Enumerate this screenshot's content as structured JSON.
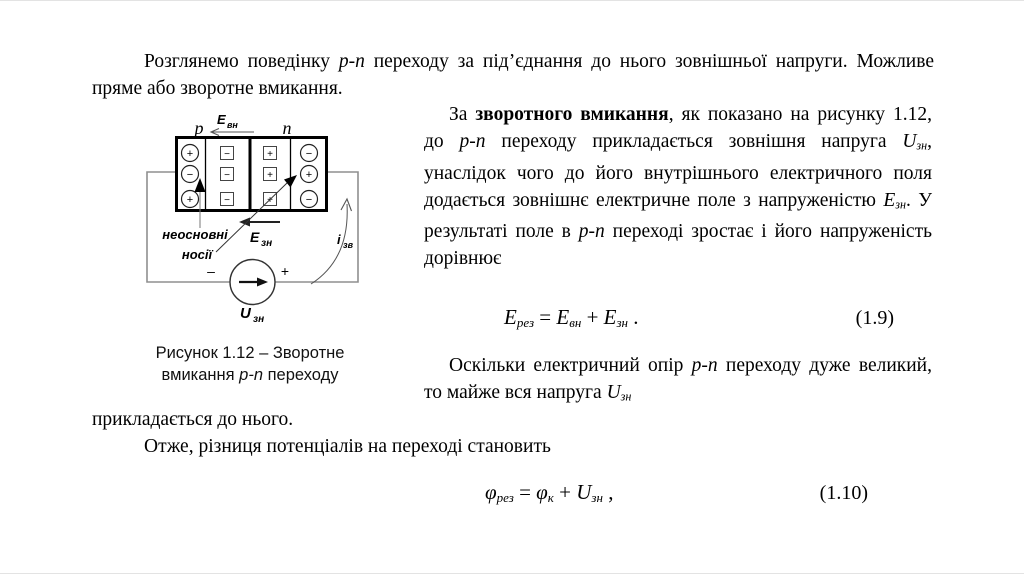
{
  "content": {
    "p1": [
      {
        "t": "Розглянемо поведінку "
      },
      {
        "t": "p-n",
        "s": "i"
      },
      {
        "t": " переходу за під’єднання до нього зовнішньої напруги. Можливе пряме або зворотне вмикання."
      }
    ],
    "p2": [
      {
        "t": "За "
      },
      {
        "t": "зворотного вмикання",
        "s": "b"
      },
      {
        "t": ", як показано на рисунку 1.12, до "
      },
      {
        "t": "p-n",
        "s": "i"
      },
      {
        "t": " переходу прикладається зовнішня напруга "
      },
      {
        "t": "U",
        "s": "i"
      },
      {
        "t": "зн",
        "s": "sub"
      },
      {
        "t": ", унаслідок чого до його внутрішнього електричного поля додається зовнішнє електричне поле з напруженістю "
      },
      {
        "t": "E",
        "s": "i"
      },
      {
        "t": "зн",
        "s": "sub"
      },
      {
        "t": ". У результаті поле в "
      },
      {
        "t": "p-n",
        "s": "i"
      },
      {
        "t": " переході зростає і його напруженість дорівнює"
      }
    ],
    "eq19": {
      "segments": [
        {
          "t": "E",
          "s": "i"
        },
        {
          "t": "рез",
          "s": "sub"
        },
        {
          "t": " = "
        },
        {
          "t": "E",
          "s": "i"
        },
        {
          "t": "вн",
          "s": "sub"
        },
        {
          "t": " + "
        },
        {
          "t": "E",
          "s": "i"
        },
        {
          "t": "зн",
          "s": "sub"
        },
        {
          "t": " ."
        }
      ],
      "number": "(1.9)"
    },
    "p3a": [
      {
        "t": "Оскільки електричний опір "
      },
      {
        "t": "p-n",
        "s": "i"
      },
      {
        "t": " переходу дуже великий, то майже вся напруга "
      },
      {
        "t": "U",
        "s": "i"
      },
      {
        "t": "зн",
        "s": "sub"
      }
    ],
    "p3b": [
      {
        "t": "прикладається до нього."
      }
    ],
    "p4": [
      {
        "t": "Отже, різниця потенціалів на переході становить"
      }
    ],
    "eq110": {
      "segments": [
        {
          "t": "φ",
          "s": "i"
        },
        {
          "t": "рез",
          "s": "sub"
        },
        {
          "t": " = "
        },
        {
          "t": "φ",
          "s": "i"
        },
        {
          "t": "к",
          "s": "sub"
        },
        {
          "t": " + "
        },
        {
          "t": "U",
          "s": "i"
        },
        {
          "t": "зн",
          "s": "sub"
        },
        {
          "t": " ,"
        }
      ],
      "number": "(1.10)"
    }
  },
  "figure": {
    "caption_line1": [
      {
        "t": "Рисунок 1.12 – Зворотне"
      }
    ],
    "caption_line2": [
      {
        "t": "вмикання "
      },
      {
        "t": "p-n",
        "s": "i"
      },
      {
        "t": " переходу"
      }
    ],
    "labels": {
      "p": "p",
      "n": "n",
      "e_vn_base": "E",
      "e_vn_sub": "вн",
      "e_zn_base": "E",
      "e_zn_sub": "зн",
      "u_zn_base": "U",
      "u_zn_sub": "зн",
      "i_zv_base": "i",
      "i_zv_sub": "зв",
      "minority_line1": "неосновні",
      "minority_line2": "носії",
      "source_minus": "–",
      "source_plus": "+"
    },
    "charges": {
      "col1": [
        "+",
        "−",
        "+"
      ],
      "col2": [
        "−",
        "−",
        "−"
      ],
      "col3": [
        "+",
        "+",
        "+"
      ],
      "col4": [
        "−",
        "+",
        "−"
      ]
    },
    "colors": {
      "wire": "#8f8f8f",
      "ink": "#000000"
    }
  }
}
